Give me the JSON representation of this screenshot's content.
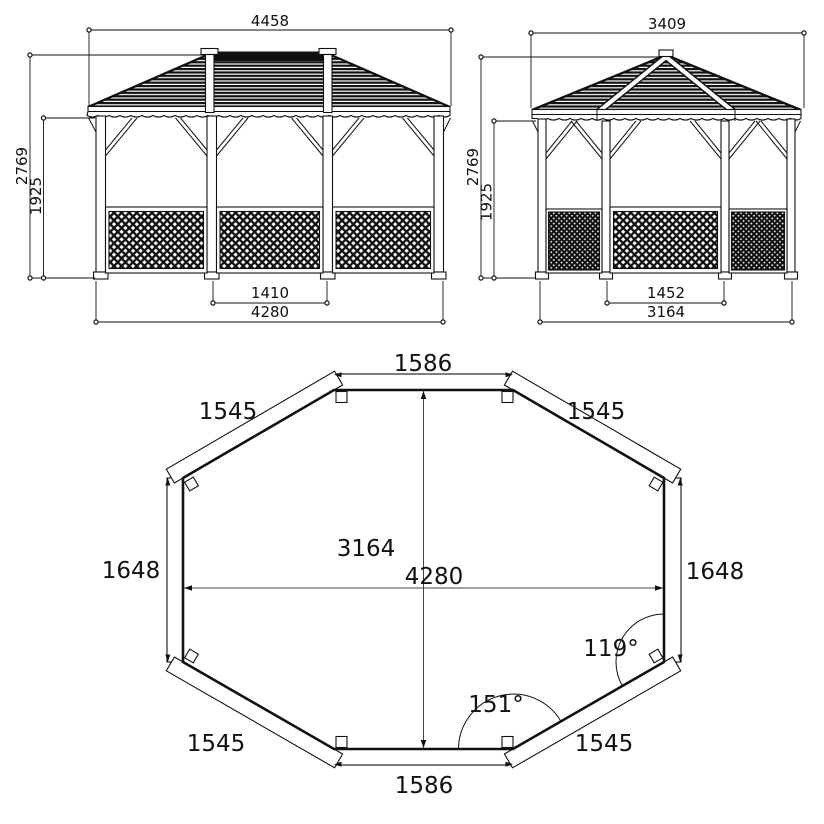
{
  "drawing": {
    "front": {
      "roof_width": "4458",
      "total_height": "2769",
      "eave_height": "1925",
      "bay_width": "1410",
      "base_width": "4280"
    },
    "side": {
      "roof_width": "3409",
      "total_height": "2769",
      "eave_height": "1925",
      "bay_width": "1452",
      "base_width": "3164"
    },
    "plan": {
      "top_side": "1586",
      "bottom_side": "1586",
      "left_side": "1648",
      "right_side": "1648",
      "diag_top_left": "1545",
      "diag_top_right": "1545",
      "diag_bottom_left": "1545",
      "diag_bottom_right": "1545",
      "overall_width": "4280",
      "overall_depth": "3164",
      "corner_angle_side": "119°",
      "corner_angle_bottom": "151°"
    }
  }
}
